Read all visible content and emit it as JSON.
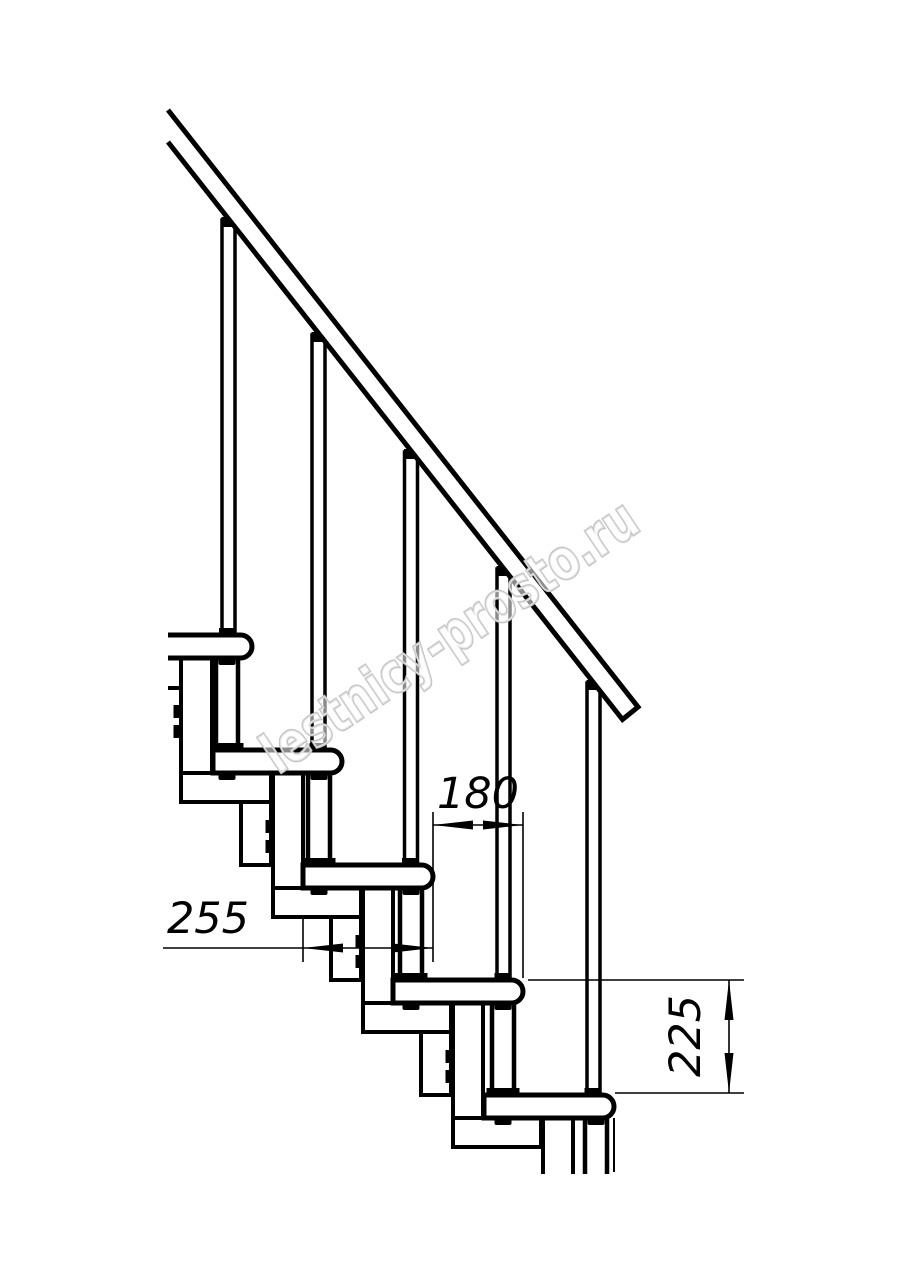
{
  "drawing": {
    "subject": "Side view technical drawing of a modular staircase section with handrail, balusters and treads",
    "background_color": "#ffffff",
    "line_color": "#000000",
    "watermark": {
      "text": "lestnicy-prosto.ru",
      "color": "#c2c2c2"
    },
    "dimensions": [
      {
        "name": "step-offset-horizontal",
        "value": "180",
        "orientation": "horizontal"
      },
      {
        "name": "tread-depth",
        "value": "255",
        "orientation": "horizontal"
      },
      {
        "name": "step-rise",
        "value": "225",
        "orientation": "vertical"
      }
    ],
    "counts": {
      "treads": 5,
      "balusters": 5,
      "handrails": 1
    }
  }
}
